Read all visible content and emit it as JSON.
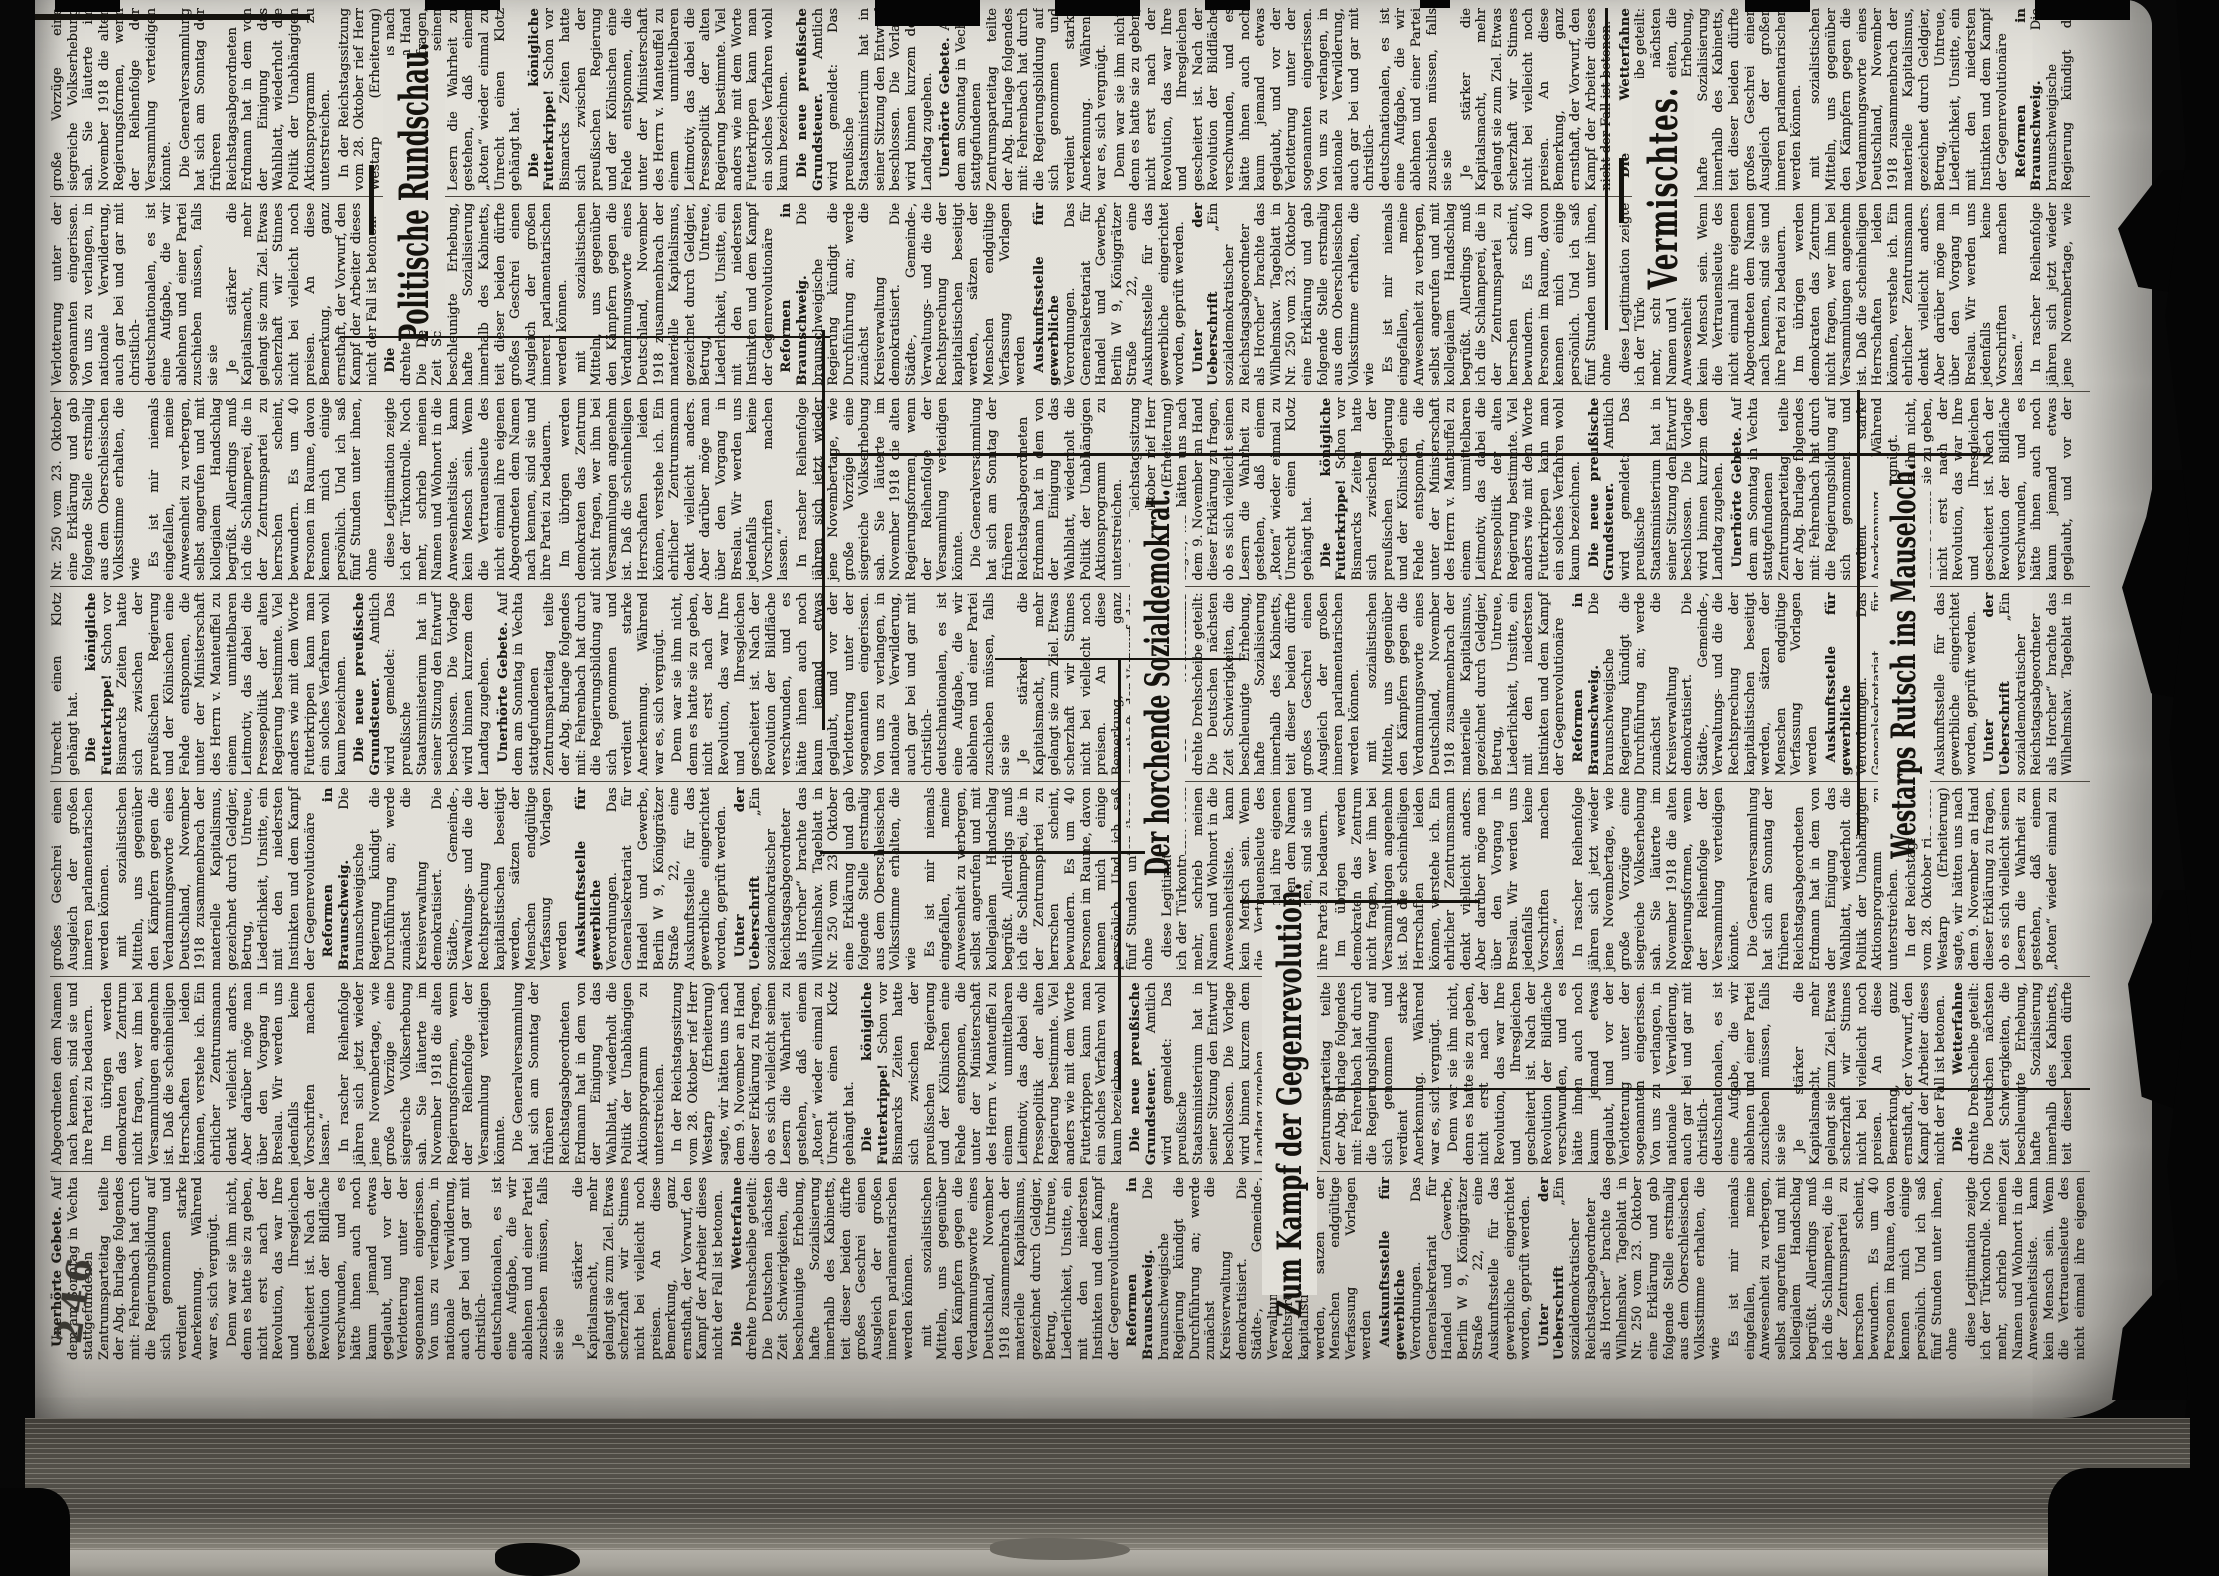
{
  "stamp": "246",
  "colors": {
    "paper": "#e2e0d9",
    "ink": "#1b1914",
    "film": "#050505"
  },
  "headlines": {
    "rundschau": "Politische Rundschau.",
    "horcher": "Der horchende Sozialdemokrat.",
    "gegenrevolution": "Zum Kampf der Gegenrevolution.",
    "westarp": "Westarps Rutsch ins Mauseloch.",
    "vermischtes": "Vermischtes."
  },
  "articles": [
    {
      "lead": "Unerhörte Gebete.",
      "text": "Auf dem am Sonntag in Vechta stattgefundenen Zentrumsparteitag teilte der Abg. Burlage folgendes mit: Fehrenbach hat durch die Regierungsbildung auf sich genommen und verdient starke Anerkennung. Während war es, sich vergnügt."
    },
    {
      "lead": "",
      "text": "Denn war sie ihm nicht, denn es hatte sie zu geben, nicht erst nach der Revolution, das war Ihre und Ihresgleichen gescheitert ist. Nach der Revolution der Bildfläche verschwunden, und es hätte ihnen auch noch kaum jemand etwas geglaubt, und vor der Verlotterung unter der sogenannten eingerissen. Von uns zu verlangen, in nationale Verwilderung, auch gar bei und gar mit christlich-deutschnationalen, es ist eine Aufgabe, die wir ablehnen und einer Partei zuschieben müssen, falls sie sie"
    },
    {
      "lead": "",
      "text": "Je stärker die Kapitalsmacht, mehr gelangt sie zum Ziel. Etwas scherzhaft wir Stinnes nicht bei vielleicht noch preisen. An diese Bemerkung, ganz ernsthaft, der Vorwurf, den Kampf der Arbeiter dieses nicht der Fall ist betonen."
    },
    {
      "lead": "Die Wetterfahne",
      "text": "drehte Drehscheibe geteilt: Die Deutschen nächsten Zeit Schwierigkeiten, die beschleunigte Erhebung, hafte Sozialisierung innerhalb des Kabinetts, teit dieser beiden dürfte großes Geschrei einen Ausgleich der großen inneren parlamentarischen werden können."
    },
    {
      "lead": "",
      "text": "mit sozialistischen Mitteln, uns gegenüber den Kämpfern gegen die Verdammungsworte eines Deutschland, November 1918 zusammenbrach der materielle Kapitalismus, gezeichnet durch Geldgier, Betrug, Untreue, Liederlichkeit, Unsitte, ein mit den niedersten Instinkten und dem Kampf der Gegenrevolutionäre"
    },
    {
      "lead": "Reformen in Braunschweig.",
      "text": "Die braunschweigische Regierung kündigt die Durchführung an; werde zunächst die Kreisverwaltung demokratisiert. Die Städte-, Gemeinde-, Verwaltungs- und die die Rechtsprechung der kapitalistischen beseitigt werden, sätzen der Menschen endgültige Verfassung Vorlagen werden"
    },
    {
      "lead": "Auskunftsstelle für gewerbliche",
      "text": "Verordnungen. Das Generalsekretariat für Handel und Gewerbe, Berlin W 9, Königgrätzer Straße 22, eine Auskunftsstelle für das gewerbliche eingerichtet worden, geprüft werden."
    },
    {
      "lead": "Unter der Ueberschrift",
      "text": "„Ein sozialdemokratischer Reichstagsabgeordneter als Horcher“ brachte das Wilhelmshav. Tageblatt in Nr. 250 vom 23. Oktober eine Erklärung und gab folgende Stelle erstmalig aus dem Oberschlesischen Volksstimme erhalten, die wie"
    },
    {
      "lead": "",
      "text": "Es ist mir niemals eingefallen, meine Anwesenheit zu verbergen, selbst angerufen und mit kollegialem Handschlag begrüßt. Allerdings muß ich die Schlamperei, die in der Zentrumspartei zu herrschen scheint, bewundern. Es um 40 Personen im Raume, davon kennen mich einige persönlich. Und ich saß fünf Stunden unter ihnen, ohne"
    },
    {
      "lead": "",
      "text": "diese Legitimation zeigte ich der Türkontrolle. Noch mehr, schrieb meinen Namen und Wohnort in die Anwesenheitsliste. kann kein Mensch sein. Wenn die Vertrauensleute des nicht einmal ihre eigenen Abgeordneten dem Namen nach kennen, sind sie und ihre Partei zu bedauern."
    },
    {
      "lead": "",
      "text": "Im übrigen werden demokraten das Zentrum nicht fragen, wer ihm bei Versammlungen angenehm ist. Daß die scheinheiligen Herrschaften leiden können, verstehe ich. Ein ehrlicher Zentrumsmann denkt vielleicht anders. Aber darüber möge man über den Vorgang in Breslau. Wir werden uns jedenfalls keine Vorschriften machen lassen.“"
    },
    {
      "lead": "",
      "text": "In rascher Reihenfolge jähren sich jetzt wieder jene Novembertage, wie große Vorzüge eine siegreiche Volkserhebung sah. Sie läuterte im November 1918 die alten Regierungsformen, wenn der Reihenfolge der Versammlung verteidigen könnte."
    },
    {
      "lead": "",
      "text": "Die Generalversammlung hat sich am Sonntag der früheren Reichstagsabgeordneten Erdmann hat in dem von der Einigung das Wahlblatt, wiederholt die Politik der Unabhängigen Aktionsprogramm zu unterstreichen."
    },
    {
      "lead": "",
      "text": "In der Reichstagssitzung vom 28. Oktober rief Herr Westarp (Erheiterung) sagte, wir hätten uns nach dem 9. November an Hand dieser Erklärung zu fragen, ob es sich vielleicht seinen Lesern die Wahrheit zu gestehen, daß einem „Roten“ wieder einmal zu Unrecht einen Klotz gehängt hat."
    },
    {
      "lead": "Die königliche Futterkrippe!",
      "text": "Schon vor Bismarcks Zeiten hatte sich zwischen der preußischen Regierung und der Kölnischen eine Fehde entsponnen, die unter der Ministerschaft des Herrn v. Manteuffel zu einem unmittelbaren Leitmotiv, das dabei die Pressepolitik der alten Regierung bestimmte. Viel anders wie mit dem Worte Futterkrippen kann man ein solches Verfahren wohl kaum bezeichnen."
    },
    {
      "lead": "Die neue preußische Grundsteuer.",
      "text": "Amtlich wird gemeldet: Das preußische Staatsministerium hat in seiner Sitzung den Entwurf beschlossen. Die Vorlage wird binnen kurzem dem Landtag zugehen."
    }
  ]
}
